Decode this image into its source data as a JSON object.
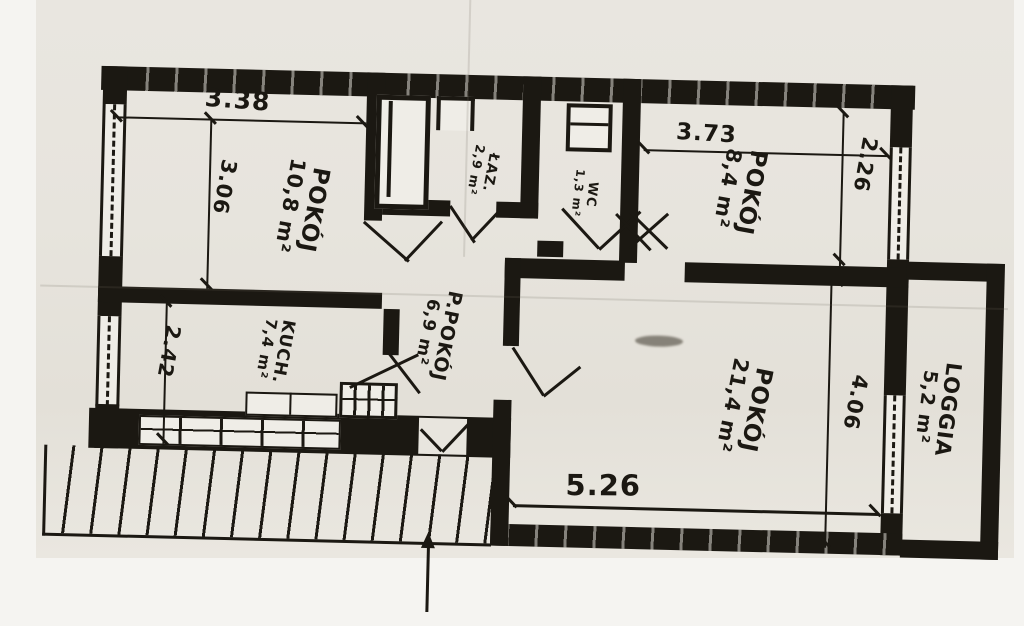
{
  "scan": {
    "ink_color": "#1b1812",
    "paper_color": "#e8e5de",
    "margin_color": "#f5f4f1"
  },
  "rooms": [
    {
      "id": "pokoj-108",
      "name": "POKÓJ",
      "area": "10,8 m²"
    },
    {
      "id": "lazienka",
      "name": "ŁAZ.",
      "area": "2,9 m²"
    },
    {
      "id": "wc",
      "name": "WC",
      "area": "1,3 m²"
    },
    {
      "id": "pokoj-84",
      "name": "POKÓJ",
      "area": "8,4 m²"
    },
    {
      "id": "przedpokoj",
      "name": "P.POKÓJ",
      "area": "6,9 m²"
    },
    {
      "id": "kuchnia",
      "name": "KUCH.",
      "area": "7,4 m²"
    },
    {
      "id": "pokoj-214",
      "name": "POKÓJ",
      "area": "21,4 m²"
    },
    {
      "id": "loggia",
      "name": "LOGGIA",
      "area": "5,2 m²"
    }
  ],
  "dimensions": {
    "top_left": "3.38",
    "left_upper": "3.06",
    "top_right": "3.73",
    "right_upper": "2.26",
    "left_lower": "2.42",
    "right_lower": "4.06",
    "bottom": "5.26"
  },
  "icons": {
    "entrance_arrow": "up-arrow"
  }
}
